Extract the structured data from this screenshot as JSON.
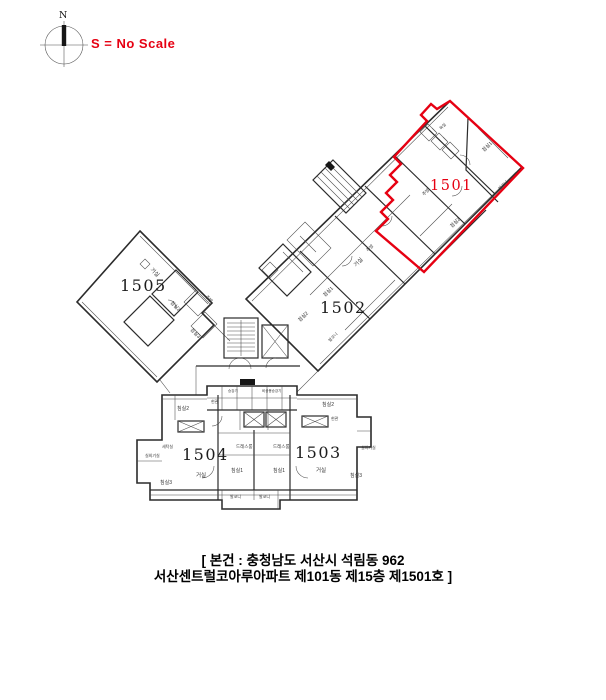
{
  "header": {
    "scale_note": "S = No Scale"
  },
  "compass": {
    "north_label": "N"
  },
  "highlighted_unit": "1501",
  "units": [
    {
      "id": "1501",
      "highlight": true,
      "color": "#e60012"
    },
    {
      "id": "1502",
      "highlight": false,
      "color": "#1c1c1c"
    },
    {
      "id": "1503",
      "highlight": false,
      "color": "#1c1c1c"
    },
    {
      "id": "1504",
      "highlight": false,
      "color": "#1c1c1c"
    },
    {
      "id": "1505",
      "highlight": false,
      "color": "#1c1c1c"
    }
  ],
  "caption": {
    "line1": "[ 본건 : 충청남도 서산시 석림동 962",
    "line2": "서산센트럴코아루아파트 제101동 제15층 제1501호 ]"
  },
  "colors": {
    "highlight": "#e60012",
    "line": "#2b2b2b",
    "text": "#000000"
  },
  "room_labels": [
    {
      "t": "침실2",
      "x": 177,
      "y": 410,
      "r": 0,
      "s": 5
    },
    {
      "t": "드레스룸",
      "x": 236,
      "y": 448,
      "r": 0,
      "s": 4.5
    },
    {
      "t": "드레스룸",
      "x": 273,
      "y": 448,
      "r": 0,
      "s": 4.5
    },
    {
      "t": "침실1",
      "x": 231,
      "y": 472,
      "r": 0,
      "s": 5
    },
    {
      "t": "침실1",
      "x": 273,
      "y": 472,
      "r": 0,
      "s": 5
    },
    {
      "t": "거실",
      "x": 196,
      "y": 477,
      "r": 0,
      "s": 5.5
    },
    {
      "t": "거실",
      "x": 316,
      "y": 472,
      "r": 0,
      "s": 5.5
    },
    {
      "t": "침실3",
      "x": 160,
      "y": 484,
      "r": 0,
      "s": 5
    },
    {
      "t": "침실3",
      "x": 350,
      "y": 477,
      "r": 0,
      "s": 5
    },
    {
      "t": "침실2",
      "x": 322,
      "y": 406,
      "r": 0,
      "s": 5
    },
    {
      "t": "세탁실",
      "x": 162,
      "y": 448,
      "r": 0,
      "s": 4
    },
    {
      "t": "실외기실",
      "x": 145,
      "y": 457,
      "r": 0,
      "s": 4
    },
    {
      "t": "실외기실",
      "x": 361,
      "y": 449,
      "r": 0,
      "s": 4
    },
    {
      "t": "발코니",
      "x": 230,
      "y": 498,
      "r": 0,
      "s": 4
    },
    {
      "t": "발코니",
      "x": 259,
      "y": 498,
      "r": 0,
      "s": 4
    },
    {
      "t": "현관",
      "x": 211,
      "y": 403,
      "r": 0,
      "s": 4
    },
    {
      "t": "현관",
      "x": 331,
      "y": 420,
      "r": 0,
      "s": 4
    },
    {
      "t": "승강기",
      "x": 228,
      "y": 392,
      "r": 0,
      "s": 3.5
    },
    {
      "t": "비상용승강기",
      "x": 262,
      "y": 392,
      "r": 0,
      "s": 3.5
    },
    {
      "t": "거실",
      "x": 356,
      "y": 267,
      "r": -45,
      "s": 5.5
    },
    {
      "t": "침실1",
      "x": 325,
      "y": 297,
      "r": -45,
      "s": 5
    },
    {
      "t": "주방",
      "x": 368,
      "y": 252,
      "r": -45,
      "s": 4.5
    },
    {
      "t": "침실2",
      "x": 300,
      "y": 322,
      "r": -45,
      "s": 5
    },
    {
      "t": "발코니",
      "x": 330,
      "y": 342,
      "r": -45,
      "s": 4
    },
    {
      "t": "침실1",
      "x": 484,
      "y": 152,
      "r": -45,
      "s": 5
    },
    {
      "t": "침실2",
      "x": 452,
      "y": 228,
      "r": -45,
      "s": 5
    },
    {
      "t": "주방",
      "x": 424,
      "y": 196,
      "r": -45,
      "s": 4.5
    },
    {
      "t": "욕실",
      "x": 441,
      "y": 130,
      "r": -45,
      "s": 4
    },
    {
      "t": "발코니",
      "x": 500,
      "y": 190,
      "r": -45,
      "s": 4
    },
    {
      "t": "거실",
      "x": 150,
      "y": 270,
      "r": 45,
      "s": 5.5
    },
    {
      "t": "침실2",
      "x": 170,
      "y": 303,
      "r": 45,
      "s": 5
    },
    {
      "t": "침실3",
      "x": 190,
      "y": 330,
      "r": 45,
      "s": 5
    },
    {
      "t": "주방",
      "x": 205,
      "y": 297,
      "r": 45,
      "s": 4.5
    }
  ]
}
